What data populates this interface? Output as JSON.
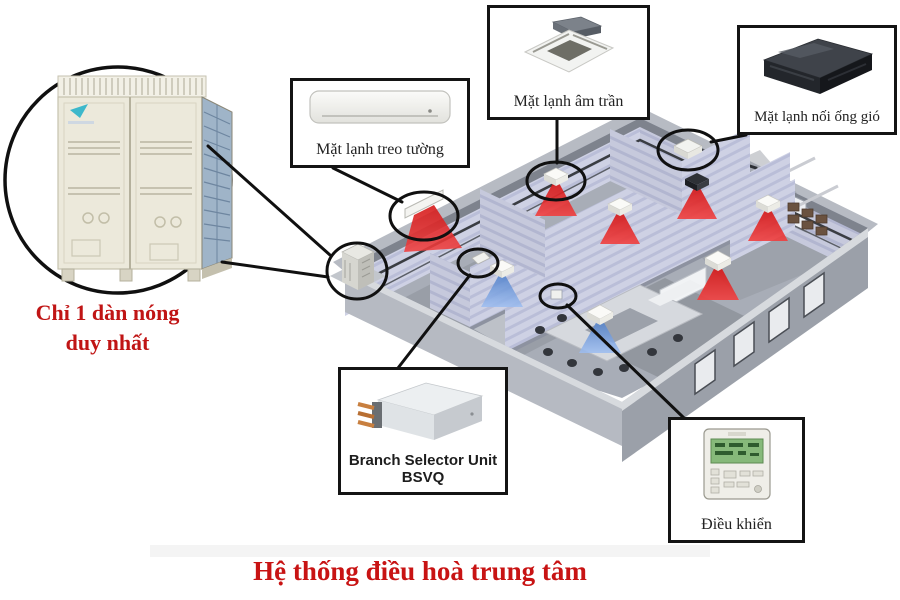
{
  "title": "Hệ thống điều hoà trung tâm",
  "outdoor_callout": {
    "caption_line1": "Chỉ 1 dàn nóng",
    "caption_line2": "duy nhất"
  },
  "labels": {
    "wall_unit": "Mặt lạnh treo tường",
    "cassette_unit": "Mặt lạnh âm trần",
    "ducted_unit": "Mặt lạnh nối ống gió",
    "branch_unit_line1": "Branch Selector Unit",
    "branch_unit_line2": "BSVQ",
    "controller": "Điều khiển"
  },
  "colors": {
    "accent_red_text": "#c01515",
    "callout_line": "#121212",
    "heating_cone": "#e02222",
    "cooling_cone": "#6e9ce2",
    "building_wall": "#cdd0e3",
    "outdoor_unit_body": "#ece9db"
  }
}
